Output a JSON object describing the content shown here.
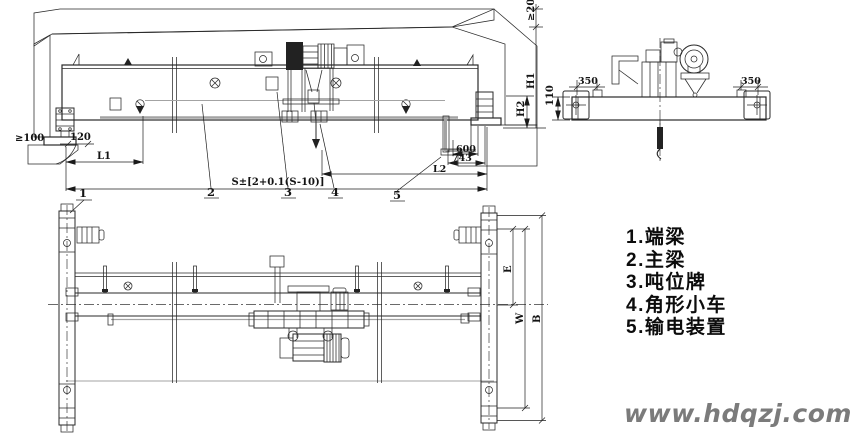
{
  "drawing_title": "overhead-crane-outline-drawing",
  "dims": {
    "clearance_left": "≥100",
    "d120": "120",
    "l1": "L1",
    "span_formula": "S±[2+0.1(S-10)]",
    "d600": "600",
    "d743": "743",
    "l2": "L2",
    "clearance_top": "≥200",
    "h1": "H1",
    "h2": "H2",
    "d110": "110",
    "d350_left": "350",
    "d350_right": "350",
    "plan_e": "E",
    "plan_w": "W",
    "plan_b": "B"
  },
  "callouts": {
    "c1": "1",
    "c2": "2",
    "c3": "3",
    "c4": "4",
    "c5": "5"
  },
  "legend": {
    "items": [
      "1.端梁",
      "2.主梁",
      "3.吨位牌",
      "4.角形小车",
      "5.输电装置"
    ]
  },
  "watermark": "www.hdqzj.com",
  "colors": {
    "line": "#2a2a2a",
    "hatch": "#5a5a5a",
    "gray_line": "#a3a3a3",
    "watermark": "#7b7b7b",
    "background": "#ffffff"
  }
}
